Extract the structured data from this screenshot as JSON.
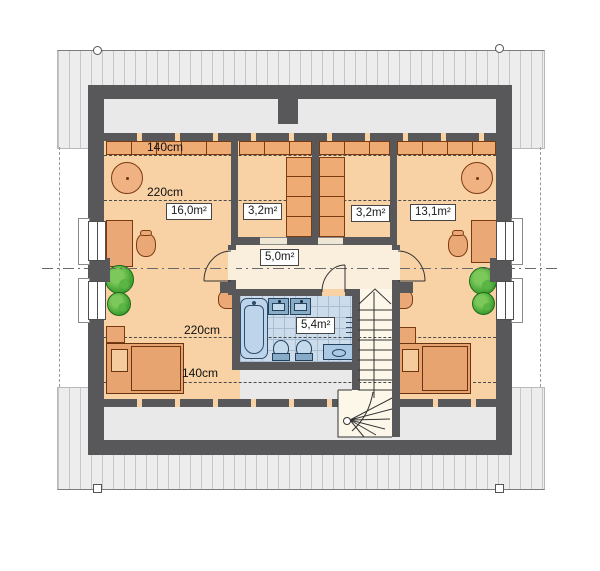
{
  "title": "Attic floor plan",
  "rooms": [
    {
      "name": "bedroom-left",
      "label": "16,0m²"
    },
    {
      "name": "closet-left",
      "label": "3,2m²"
    },
    {
      "name": "closet-right",
      "label": "3,2m²"
    },
    {
      "name": "bedroom-right",
      "label": "13,1m²"
    },
    {
      "name": "hallway",
      "label": "5,0m²"
    },
    {
      "name": "bathroom",
      "label": "5,4m²"
    }
  ],
  "dimensions": {
    "top_140": "140cm",
    "top_220": "220cm",
    "bottom_220": "220cm",
    "bottom_140": "140cm"
  },
  "colors": {
    "wall": "#58585a",
    "room_floor": "#f8d2a4",
    "hall_floor": "#faeedd",
    "bath_tile": "#ccdcea",
    "fixture_blue": "#a9c9e4",
    "furniture_wood": "#eaa876",
    "plant_green": "#3f9e33",
    "roof_gray": "#ededed"
  }
}
